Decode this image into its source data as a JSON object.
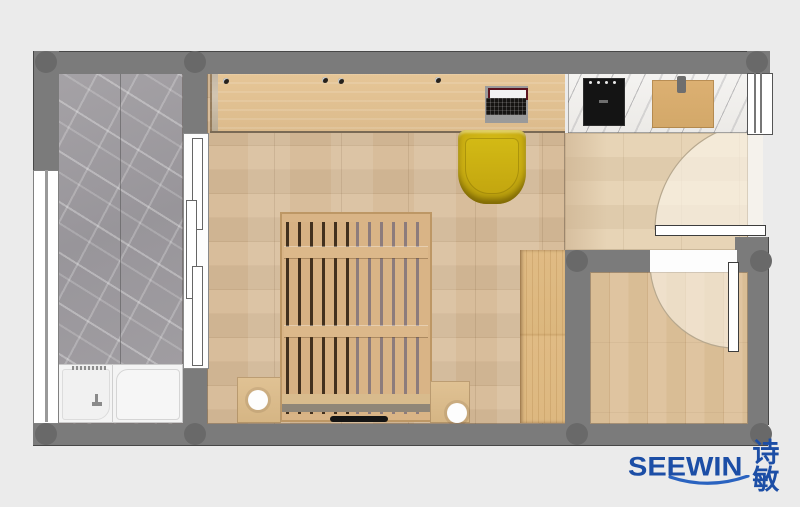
{
  "brand": {
    "name": "SEEWIN",
    "name_cn": "诗敏"
  },
  "palette": {
    "background": "#ebebeb",
    "wall": "#7b7b7b",
    "column": "#696969",
    "bedroom_floor": "#cfb492",
    "corridor_floor": "#e7d4b6",
    "storage_floor": "#d9bd95",
    "bath_marble": "#9c999d",
    "counter_marble": "#f2f1ef",
    "desk_wood": "#dfbf90",
    "bed_wood": "#d9b486",
    "chair_yellow": "#c9ad12",
    "logo_blue": "#1c4ea6"
  },
  "plan": {
    "rooms": [
      {
        "id": "bathroom",
        "floor": "gray-marble",
        "furniture": [
          "bathtub",
          "shower-tray",
          "faucet",
          "sliding-door",
          "window"
        ]
      },
      {
        "id": "bedroom",
        "floor": "oak-plank",
        "furniture": [
          "desk",
          "laptop",
          "desk-chair",
          "slatted-bed",
          "nightstand-left",
          "table-lamp-left",
          "nightstand-right",
          "table-lamp-right",
          "wardrobe"
        ]
      },
      {
        "id": "kitchenette",
        "floor": "oak-plank",
        "furniture": [
          "marble-counter",
          "induction-cooktop",
          "cutting-board",
          "window"
        ]
      },
      {
        "id": "entry-hall",
        "floor": "light-oak",
        "furniture": [
          "entry-door"
        ]
      },
      {
        "id": "storage-room",
        "floor": "light-oak",
        "furniture": [
          "interior-door"
        ]
      }
    ]
  }
}
